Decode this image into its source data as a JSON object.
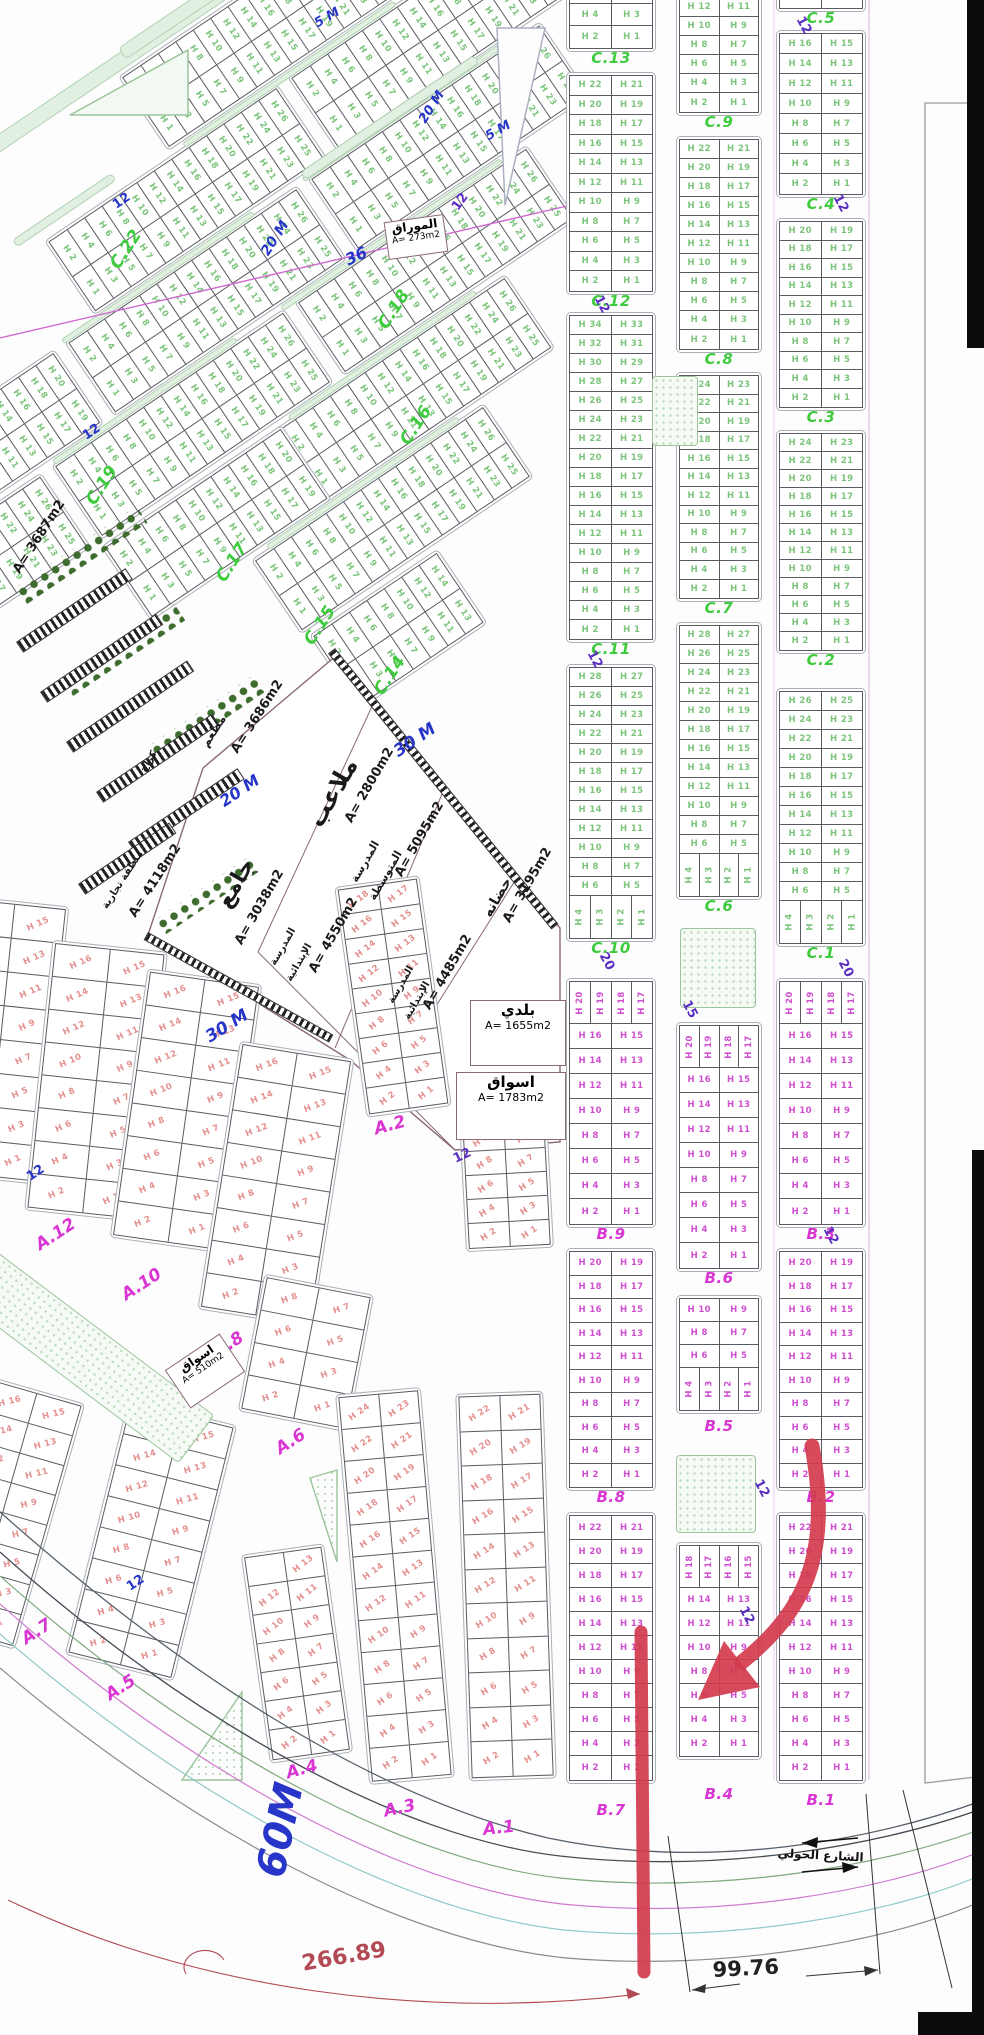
{
  "colors": {
    "h_green": "#7cc47c",
    "h_magenta": "#cf4fcf",
    "h_pink": "#e4908f",
    "label_green": "#3ecb3e",
    "label_magenta": "#d935d2",
    "street_blue": "#2736c8",
    "number_purple": "#5b2fc0",
    "dim_red": "#b24a55",
    "annotation_red": "#d23b4e",
    "text_black": "#1a1a1a"
  },
  "legend": {
    "plot_prefix": "H"
  },
  "right_strips": [
    {
      "x": 566,
      "w": 90,
      "blocks": [
        {
          "y": -44,
          "from": 8,
          "rh": 22,
          "c": "g",
          "label": "C.13"
        },
        {
          "y": 72,
          "from": 22,
          "rh": 19.5,
          "c": "g",
          "label": "C.12"
        },
        {
          "y": 312,
          "from": 34,
          "rh": 19,
          "c": "g",
          "label": "C.11"
        },
        {
          "y": 664,
          "from": 28,
          "to": 5,
          "rh": 19,
          "vb": [
            4,
            3,
            2,
            1
          ],
          "c": "g",
          "label": "C.10"
        },
        {
          "y": 978,
          "vt": [
            20,
            19,
            18,
            17
          ],
          "from": 16,
          "rh": 25,
          "c": "m",
          "label": "B.9"
        },
        {
          "y": 1248,
          "from": 20,
          "rh": 23.5,
          "c": "m",
          "label": "B.8"
        },
        {
          "y": 1512,
          "from": 22,
          "rh": 24,
          "c": "m",
          "label": "B.7",
          "ldy": 20
        }
      ]
    },
    {
      "x": 676,
      "w": 86,
      "blocks": [
        {
          "y": -6,
          "from": 12,
          "rh": 19,
          "c": "g",
          "label": "C.9"
        },
        {
          "y": 136,
          "from": 22,
          "rh": 19,
          "c": "g",
          "label": "C.8"
        },
        {
          "y": 372,
          "from": 24,
          "rh": 18.5,
          "c": "g",
          "label": "C.7"
        },
        {
          "y": 622,
          "from": 28,
          "to": 5,
          "rh": 19,
          "vb": [
            4,
            3,
            2,
            1
          ],
          "c": "g",
          "label": "C.6"
        },
        {
          "y": 1022,
          "vt": [
            20,
            19,
            18,
            17
          ],
          "from": 16,
          "rh": 25,
          "c": "m",
          "label": "B.6"
        },
        {
          "y": 1295,
          "from": 10,
          "to": 5,
          "rh": 23,
          "vb": [
            4,
            3,
            2,
            1
          ],
          "c": "m",
          "label": "B.5",
          "ldy": 6
        },
        {
          "y": 1542,
          "vt": [
            18,
            17,
            16,
            15
          ],
          "from": 14,
          "rh": 24,
          "c": "m",
          "label": "B.4",
          "ldy": 28
        }
      ]
    },
    {
      "x": 776,
      "w": 90,
      "blocks": [
        {
          "y": -62,
          "from": 6,
          "rh": 22,
          "c": "g",
          "label": "C.5"
        },
        {
          "y": 30,
          "from": 16,
          "rh": 20,
          "c": "g",
          "label": "C.4"
        },
        {
          "y": 218,
          "from": 20,
          "rh": 18.5,
          "c": "g",
          "label": "C.3"
        },
        {
          "y": 430,
          "from": 24,
          "rh": 18,
          "c": "g",
          "label": "C.2"
        },
        {
          "y": 688,
          "from": 26,
          "to": 5,
          "rh": 19,
          "vb": [
            4,
            3,
            2,
            1
          ],
          "c": "g",
          "label": "C.1"
        },
        {
          "y": 978,
          "vt": [
            20,
            19,
            18,
            17
          ],
          "from": 16,
          "rh": 25,
          "c": "m",
          "label": "B.3"
        },
        {
          "y": 1248,
          "from": 20,
          "rh": 23.5,
          "c": "m",
          "label": "B.2"
        },
        {
          "y": 1512,
          "from": 22,
          "rh": 24,
          "c": "m",
          "label": "B.1",
          "ldy": 10
        }
      ]
    }
  ],
  "diag_origin": {
    "x": 520,
    "y": -80,
    "rot": 56
  },
  "diag_blocks": [
    {
      "x": -95,
      "y": 140,
      "from": 26
    },
    {
      "x": 0,
      "y": 0,
      "from": 26
    },
    {
      "x": 0,
      "y": 293,
      "from": 26
    },
    {
      "x": 95,
      "y": 40,
      "from": 26
    },
    {
      "x": 95,
      "y": 333,
      "from": 26
    },
    {
      "x": 95,
      "y": 626,
      "from": 20
    },
    {
      "x": 190,
      "y": 120,
      "from": 26
    },
    {
      "x": 190,
      "y": 413,
      "from": 26
    },
    {
      "x": 190,
      "y": 706,
      "from": 26
    },
    {
      "x": 285,
      "y": 210,
      "from": 26
    },
    {
      "x": 285,
      "y": 480,
      "from": 20
    },
    {
      "x": 380,
      "y": 300,
      "from": 26
    },
    {
      "x": 475,
      "y": 420,
      "from": 14
    }
  ],
  "diag_medians": [
    {
      "x": 91,
      "y": 55,
      "len": 270
    },
    {
      "x": 91,
      "y": 385,
      "len": 230
    },
    {
      "x": 186,
      "y": 150,
      "len": 265
    },
    {
      "x": 186,
      "y": 470,
      "len": 220
    },
    {
      "x": 281,
      "y": 245,
      "len": 225
    },
    {
      "x": 376,
      "y": 330,
      "len": 230
    },
    {
      "x": -4,
      "y": 150,
      "len": 255
    }
  ],
  "sw_blocks": [
    {
      "x": -55,
      "y": 900,
      "w": 110,
      "from": 16,
      "rh": 34,
      "rot": 6
    },
    {
      "x": 38,
      "y": 945,
      "w": 116,
      "from": 16,
      "rh": 33,
      "rot": 6
    },
    {
      "x": 128,
      "y": 975,
      "w": 116,
      "from": 16,
      "rh": 33,
      "rot": 8
    },
    {
      "x": 218,
      "y": 1048,
      "w": 116,
      "from": 16,
      "rh": 33,
      "rot": 9
    },
    {
      "x": 250,
      "y": 1283,
      "w": 112,
      "from": 8,
      "rh": 33,
      "rot": 11
    },
    {
      "x": 95,
      "y": 1408,
      "w": 112,
      "from": 16,
      "rh": 32,
      "rot": 14
    },
    {
      "x": -48,
      "y": 1385,
      "w": 100,
      "from": 16,
      "rh": 31,
      "rot": 16
    },
    {
      "x": 255,
      "y": 1548,
      "w": 84,
      "from": 13,
      "rh": 29,
      "rot": -8
    },
    {
      "x": 350,
      "y": 880,
      "w": 86,
      "from": 18,
      "rh": 25,
      "rot": -8
    },
    {
      "x": 352,
      "y": 1390,
      "w": 86,
      "from": 24,
      "rh": 32,
      "rot": -5
    },
    {
      "x": 462,
      "y": 1098,
      "w": 88,
      "from": 12,
      "rh": 24,
      "rot": -3
    },
    {
      "x": 462,
      "y": 1392,
      "w": 88,
      "from": 22,
      "rh": 34.5,
      "rot": -2
    }
  ],
  "zone_labels": [
    {
      "t": "C.22",
      "x": 106,
      "y": 262,
      "r": -57,
      "c": "g"
    },
    {
      "t": "C.18",
      "x": 374,
      "y": 322,
      "r": -57,
      "c": "g"
    },
    {
      "t": "C.16",
      "x": 396,
      "y": 438,
      "r": -57,
      "c": "g"
    },
    {
      "t": "C.19",
      "x": 82,
      "y": 498,
      "r": -57,
      "c": "g"
    },
    {
      "t": "C.17",
      "x": 212,
      "y": 575,
      "r": -57,
      "c": "g"
    },
    {
      "t": "C.15",
      "x": 300,
      "y": 638,
      "r": -57,
      "c": "g"
    },
    {
      "t": "C.14",
      "x": 370,
      "y": 688,
      "r": -57,
      "c": "g"
    },
    {
      "t": "A.12",
      "x": 32,
      "y": 1238,
      "r": -33,
      "c": "a"
    },
    {
      "t": "A.10",
      "x": 118,
      "y": 1288,
      "r": -33,
      "c": "a"
    },
    {
      "t": "A.8",
      "x": 210,
      "y": 1345,
      "r": -33,
      "c": "a"
    },
    {
      "t": "A.6",
      "x": 272,
      "y": 1442,
      "r": -33,
      "c": "a"
    },
    {
      "t": "A.7",
      "x": 18,
      "y": 1632,
      "r": -33,
      "c": "a"
    },
    {
      "t": "A.5",
      "x": 102,
      "y": 1688,
      "r": -33,
      "c": "a"
    },
    {
      "t": "A.2",
      "x": 372,
      "y": 1120,
      "r": -15,
      "c": "a"
    },
    {
      "t": "A.4",
      "x": 284,
      "y": 1764,
      "r": -15,
      "c": "a"
    },
    {
      "t": "A.3",
      "x": 382,
      "y": 1802,
      "r": -12,
      "c": "a"
    },
    {
      "t": "A.1",
      "x": 482,
      "y": 1820,
      "r": -6,
      "c": "a"
    }
  ],
  "street_labels": [
    {
      "t": "5 M",
      "x": 312,
      "y": 18,
      "r": -30,
      "s": 13
    },
    {
      "t": "5 M",
      "x": 483,
      "y": 131,
      "r": -30,
      "s": 13
    },
    {
      "t": "20 M",
      "x": 416,
      "y": 118,
      "r": -57,
      "s": 13
    },
    {
      "t": "20 M",
      "x": 258,
      "y": 250,
      "r": -57,
      "s": 14
    },
    {
      "t": "36",
      "x": 342,
      "y": 252,
      "r": -25,
      "s": 16
    },
    {
      "t": "20 M",
      "x": 216,
      "y": 795,
      "r": -34,
      "s": 16
    },
    {
      "t": "30 M",
      "x": 390,
      "y": 745,
      "r": -34,
      "s": 17
    },
    {
      "t": "30 M",
      "x": 202,
      "y": 1030,
      "r": -32,
      "s": 17
    },
    {
      "t": "60M",
      "x": 248,
      "y": 1872,
      "r": -78,
      "s": 40
    }
  ],
  "street_numbers": [
    {
      "t": "12",
      "x": 449,
      "y": 205,
      "r": -55,
      "c": "p"
    },
    {
      "t": "12",
      "x": 604,
      "y": 293,
      "r": 62,
      "c": "p"
    },
    {
      "t": "12",
      "x": 597,
      "y": 648,
      "r": 62,
      "c": "p"
    },
    {
      "t": "20",
      "x": 609,
      "y": 950,
      "r": 62,
      "c": "p"
    },
    {
      "t": "12",
      "x": 806,
      "y": 14,
      "r": 62,
      "c": "p"
    },
    {
      "t": "12",
      "x": 843,
      "y": 192,
      "r": 62,
      "c": "p"
    },
    {
      "t": "20",
      "x": 848,
      "y": 957,
      "r": 62,
      "c": "p"
    },
    {
      "t": "15",
      "x": 692,
      "y": 998,
      "r": 62,
      "c": "p"
    },
    {
      "t": "12",
      "x": 833,
      "y": 1224,
      "r": 62,
      "c": "p"
    },
    {
      "t": "12",
      "x": 764,
      "y": 1477,
      "r": 62,
      "c": "p"
    },
    {
      "t": "12",
      "x": 749,
      "y": 1604,
      "r": 62,
      "c": "p"
    },
    {
      "t": "12",
      "x": 451,
      "y": 1153,
      "r": -25,
      "c": "p"
    },
    {
      "t": "12",
      "x": 110,
      "y": 200,
      "r": -34,
      "c": "b"
    },
    {
      "t": "12",
      "x": 80,
      "y": 431,
      "r": -34,
      "c": "b"
    },
    {
      "t": "12",
      "x": 24,
      "y": 1172,
      "r": -34,
      "c": "b"
    },
    {
      "t": "12",
      "x": 124,
      "y": 1582,
      "r": -34,
      "c": "b"
    }
  ],
  "facility_labels": [
    {
      "t": "A= 3687m2",
      "x": 10,
      "y": 568,
      "r": -57,
      "s": 13
    },
    {
      "t": "مطعم",
      "x": 198,
      "y": 742,
      "r": -57,
      "s": 12
    },
    {
      "t": "A= 3686m2",
      "x": 228,
      "y": 748,
      "r": -57,
      "s": 13
    },
    {
      "t": "كراج",
      "x": 138,
      "y": 768,
      "r": -57,
      "s": 10
    },
    {
      "t": "منطقة تجارية",
      "x": 100,
      "y": 905,
      "r": -57,
      "s": 10
    },
    {
      "t": "A= 4118m2",
      "x": 126,
      "y": 912,
      "r": -57,
      "s": 13
    },
    {
      "t": "ملاعب",
      "x": 302,
      "y": 818,
      "r": -60,
      "s": 24
    },
    {
      "t": "A= 2800m2",
      "x": 342,
      "y": 818,
      "r": -60,
      "s": 13
    },
    {
      "t": "المدرسة",
      "x": 348,
      "y": 878,
      "r": -60,
      "s": 11
    },
    {
      "t": "المتوسطة",
      "x": 366,
      "y": 896,
      "r": -60,
      "s": 11
    },
    {
      "t": "A= 5095m2",
      "x": 392,
      "y": 872,
      "r": -60,
      "s": 13
    },
    {
      "t": "جامع",
      "x": 212,
      "y": 900,
      "r": -60,
      "s": 22
    },
    {
      "t": "A= 3038m2",
      "x": 232,
      "y": 940,
      "r": -60,
      "s": 13
    },
    {
      "t": "المدرسة",
      "x": 268,
      "y": 962,
      "r": -60,
      "s": 10
    },
    {
      "t": "الإبتدائية",
      "x": 284,
      "y": 978,
      "r": -60,
      "s": 10
    },
    {
      "t": "A= 4550m2",
      "x": 306,
      "y": 968,
      "r": -60,
      "s": 13
    },
    {
      "t": "حضانه",
      "x": 480,
      "y": 912,
      "r": -60,
      "s": 14
    },
    {
      "t": "A= 3195m2",
      "x": 500,
      "y": 918,
      "r": -60,
      "s": 13
    },
    {
      "t": "المدرسة",
      "x": 386,
      "y": 1000,
      "r": -60,
      "s": 10
    },
    {
      "t": "الإبتدائية",
      "x": 402,
      "y": 1016,
      "r": -60,
      "s": 10
    },
    {
      "t": "A= 4485m2",
      "x": 420,
      "y": 1005,
      "r": -60,
      "s": 13
    }
  ],
  "facility_boxes": [
    {
      "name": "baladi",
      "t1": "بلدي",
      "t2": "A= 1655m2",
      "x": 470,
      "y": 1000,
      "w": 96,
      "h": 66,
      "r": 0
    },
    {
      "name": "aswaq",
      "t1": "اسواق",
      "t2": "A= 1783m2",
      "x": 456,
      "y": 1072,
      "w": 110,
      "h": 68,
      "r": 0
    },
    {
      "name": "aswaq-small",
      "t1": "اسواق",
      "t2": "A= 510m2",
      "x": 172,
      "y": 1348,
      "w": 66,
      "h": 46,
      "r": -34
    },
    {
      "name": "mawraq",
      "t1": "الموراق",
      "t2": "A= 273m2",
      "x": 386,
      "y": 218,
      "w": 60,
      "h": 38,
      "r": -8
    }
  ],
  "annotations": {
    "dim_curve_value": "266.89",
    "dim_straight_value": "99.76",
    "street_name": "الشارع الحولي"
  },
  "decor": {
    "tree_bars": [
      {
        "x": 12,
        "y": 590,
        "w": 150,
        "h": 20,
        "r": -34
      },
      {
        "x": 58,
        "y": 682,
        "w": 140,
        "h": 20,
        "r": -34
      },
      {
        "x": 146,
        "y": 748,
        "w": 130,
        "h": 20,
        "r": -34
      },
      {
        "x": 152,
        "y": 922,
        "w": 120,
        "h": 18,
        "r": -34
      }
    ],
    "hatch_bars": [
      {
        "x": 16,
        "y": 642,
        "w": 132,
        "h": 13,
        "r": -34
      },
      {
        "x": 40,
        "y": 692,
        "w": 140,
        "h": 13,
        "r": -34
      },
      {
        "x": 66,
        "y": 742,
        "w": 146,
        "h": 13,
        "r": -34
      },
      {
        "x": 96,
        "y": 792,
        "w": 140,
        "h": 13,
        "r": -34
      },
      {
        "x": 128,
        "y": 842,
        "w": 132,
        "h": 13,
        "r": -34
      },
      {
        "x": 78,
        "y": 884,
        "w": 110,
        "h": 13,
        "r": -34
      }
    ],
    "wall_hatches": [
      {
        "x": 335,
        "y": 648,
        "w": 355,
        "h": 9,
        "r": 51
      },
      {
        "x": 148,
        "y": 932,
        "w": 212,
        "h": 9,
        "r": 29
      }
    ],
    "road_medians": [
      {
        "x": -40,
        "y": 160,
        "w": 330,
        "h": 16,
        "r": -34
      },
      {
        "x": 118,
        "y": 48,
        "w": 250,
        "h": 14,
        "r": -34
      },
      {
        "x": 12,
        "y": 240,
        "w": 120,
        "h": 9,
        "r": -34
      },
      {
        "x": 300,
        "y": 172,
        "w": 210,
        "h": 10,
        "r": -34
      }
    ],
    "parks": [
      {
        "x": 652,
        "y": 376,
        "w": 46,
        "h": 70
      },
      {
        "x": 680,
        "y": 928,
        "w": 76,
        "h": 80
      },
      {
        "x": 676,
        "y": 1455,
        "w": 80,
        "h": 78
      }
    ],
    "park_band": {
      "x": -25,
      "y": 1235,
      "w": 300,
      "h": 60,
      "r": 37
    }
  }
}
